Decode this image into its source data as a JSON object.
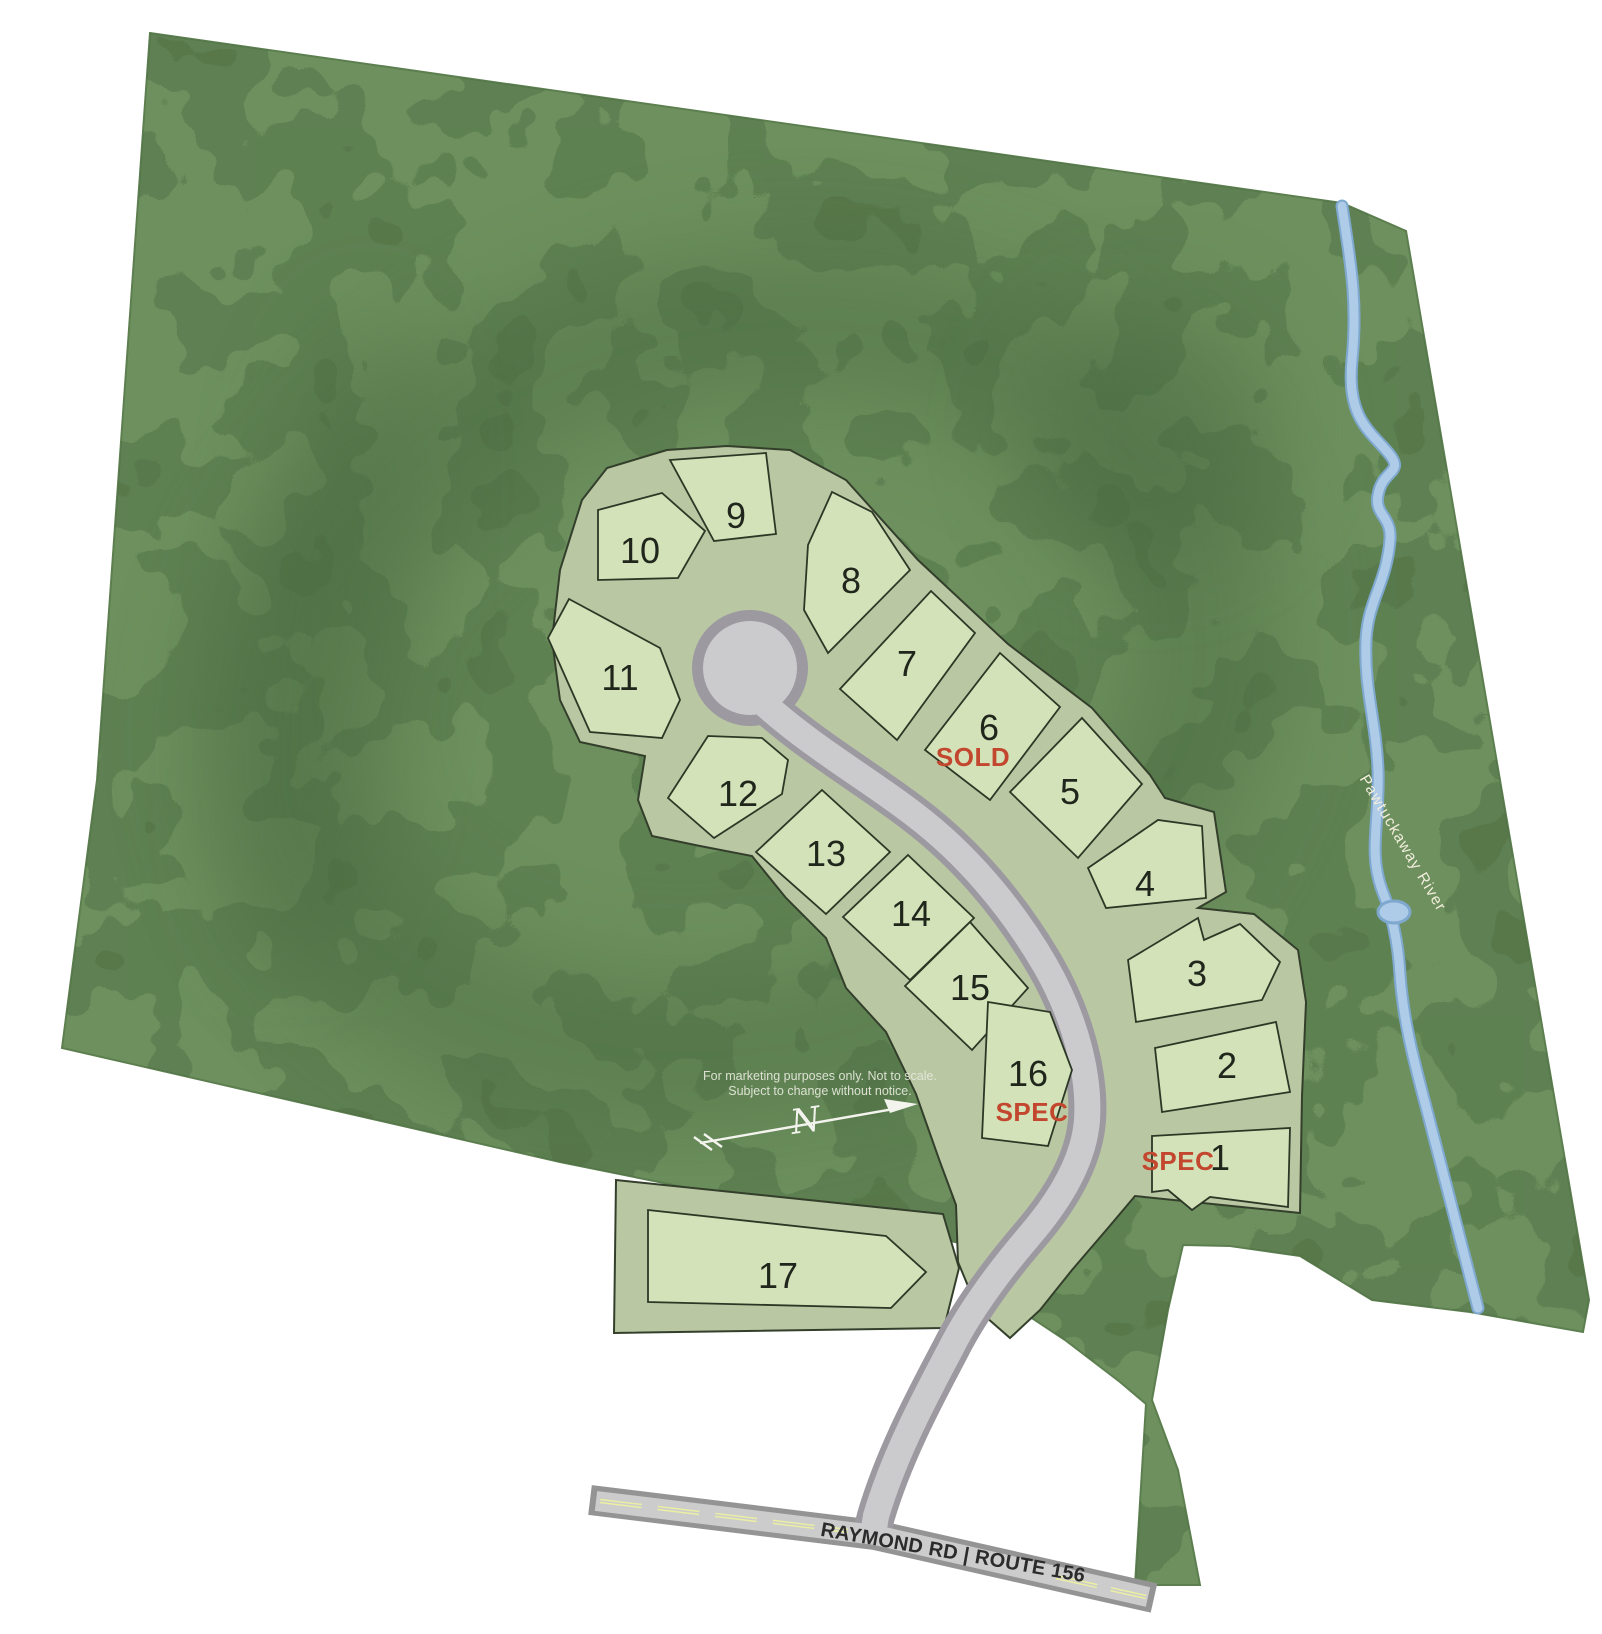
{
  "legend": {
    "disclaimer_line1": "For marketing purposes only. Not to scale.",
    "disclaimer_line2": "Subject to change without notice."
  },
  "compass": {
    "north_label": "N"
  },
  "labels": {
    "river": "Pawtuckaway River",
    "road": "RAYMOND RD | ROUTE 156"
  },
  "statuses": {
    "sold": "SOLD",
    "spec": "SPEC"
  },
  "colors": {
    "terrain_green": "#6d905e",
    "terrain_dark": "#4c6d42",
    "parcel_buffer": "#bac7a3",
    "lot_fill": "#d3e2b8",
    "lot_outline": "#2c3825",
    "road_fill": "#cbcbcd",
    "road_casing": "#9c99a1",
    "highway_casing": "#949494",
    "river_blue": "#aecbe8",
    "status_red": "#c2472e",
    "centerline_yellow": "#ecefa3"
  },
  "lots": [
    {
      "number": "1",
      "status": "SPEC",
      "points": "1152,1136 1290,1128 1288,1207 1210,1197 1192,1210 1168,1190 1152,1192",
      "nx": 1220,
      "ny": 1170,
      "sx": 1178,
      "sy": 1170
    },
    {
      "number": "2",
      "status": null,
      "points": "1155,1048 1276,1022 1290,1092 1162,1112",
      "nx": 1227,
      "ny": 1078
    },
    {
      "number": "3",
      "status": null,
      "points": "1128,960 1198,918 1204,940 1240,924 1280,962 1262,1000 1136,1022",
      "nx": 1197,
      "ny": 986
    },
    {
      "number": "4",
      "status": null,
      "points": "1088,868 1158,820 1202,826 1206,898 1106,908",
      "nx": 1145,
      "ny": 896
    },
    {
      "number": "5",
      "status": null,
      "points": "1082,718 1142,784 1078,858 1010,792",
      "nx": 1070,
      "ny": 804
    },
    {
      "number": "6",
      "status": "SOLD",
      "points": "1000,653 1060,707 990,800 925,750",
      "nx": 989,
      "ny": 740,
      "sx": 973,
      "sy": 766
    },
    {
      "number": "7",
      "status": null,
      "points": "931,591 975,633 897,740 840,689",
      "nx": 907,
      "ny": 676
    },
    {
      "number": "8",
      "status": null,
      "points": "808,545 832,492 872,512 910,570 828,653 804,610",
      "nx": 851,
      "ny": 593
    },
    {
      "number": "9",
      "status": null,
      "points": "670,460 766,453 776,534 714,541",
      "nx": 736,
      "ny": 528
    },
    {
      "number": "10",
      "status": null,
      "points": "598,510 662,493 705,531 678,578 598,580",
      "nx": 640,
      "ny": 563
    },
    {
      "number": "11",
      "status": null,
      "points": "569,599 660,648 680,700 662,738 590,732 548,638",
      "nx": 620,
      "ny": 690
    },
    {
      "number": "12",
      "status": null,
      "points": "668,798 708,736 762,738 788,760 782,794 714,838",
      "nx": 738,
      "ny": 806
    },
    {
      "number": "13",
      "status": null,
      "points": "822,790 890,852 826,914 756,852",
      "nx": 826,
      "ny": 866
    },
    {
      "number": "14",
      "status": null,
      "points": "908,855 974,918 910,980 843,917",
      "nx": 911,
      "ny": 926
    },
    {
      "number": "15",
      "status": null,
      "points": "970,922 1028,988 972,1050 905,986",
      "nx": 970,
      "ny": 1000
    },
    {
      "number": "16",
      "status": "SPEC",
      "points": "988,1002 1050,1012 1072,1070 1048,1146 982,1138",
      "nx": 1028,
      "ny": 1086,
      "sx": 1032,
      "sy": 1121
    },
    {
      "number": "17",
      "status": null,
      "points": "648,1210 886,1236 926,1272 891,1308 648,1302",
      "nx": 778,
      "ny": 1288
    }
  ]
}
